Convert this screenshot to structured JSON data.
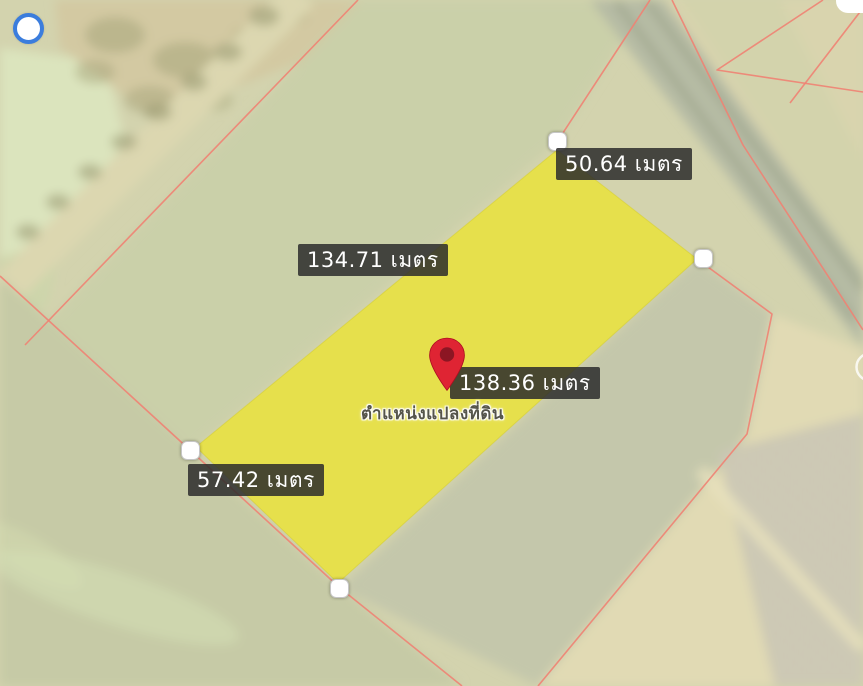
{
  "map": {
    "caption": "ตำแหน่งแปลงที่ดิน",
    "unit_label": "เมตร",
    "measurements": [
      {
        "side": "northeast",
        "value": 50.64,
        "label": "50.64 เมตร"
      },
      {
        "side": "northwest",
        "value": 134.71,
        "label": "134.71 เมตร"
      },
      {
        "side": "southeast",
        "value": 138.36,
        "label": "138.36 เมตร"
      },
      {
        "side": "southwest",
        "value": 57.42,
        "label": "57.42 เมตร"
      }
    ],
    "plot": {
      "vertex_count": 4
    },
    "icons": {
      "gps_circle": "blue ring location dot",
      "location_pin": "red map pin",
      "vertex_handle": "white rounded-square drag handle"
    },
    "colors": {
      "plot_fill": "#ece431",
      "parcel_line": "#ef8273",
      "label_bg": "rgba(43,43,43,0.85)",
      "label_text": "#ffffff",
      "pin_red": "#df2433",
      "pin_core": "#8c1623",
      "gps_blue": "#3b7ddd"
    }
  }
}
